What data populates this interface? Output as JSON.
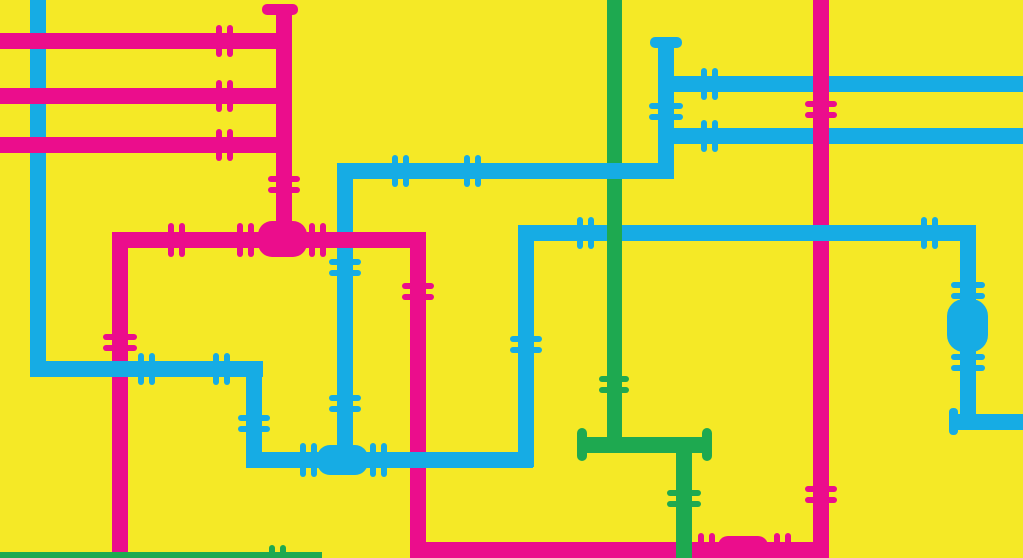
{
  "canvas": {
    "width": 1023,
    "height": 558,
    "background": "#F5E926"
  },
  "colors": {
    "magenta": "#EB0D8C",
    "cyan": "#16ACE4",
    "green": "#1EA950",
    "yellow": "#F5E926"
  },
  "pipes": [
    {
      "name": "pink-top-h1",
      "color": "magenta",
      "x": 0,
      "y": 33,
      "w": 292,
      "h": 16,
      "z": 2
    },
    {
      "name": "pink-top-h2",
      "color": "magenta",
      "x": 0,
      "y": 88,
      "w": 292,
      "h": 16,
      "z": 2
    },
    {
      "name": "pink-top-h3",
      "color": "magenta",
      "x": 0,
      "y": 137,
      "w": 292,
      "h": 16,
      "z": 2
    },
    {
      "name": "pink-capped-v",
      "color": "magenta",
      "x": 276,
      "y": 10,
      "w": 16,
      "h": 230,
      "z": 2
    },
    {
      "name": "pink-mid-h",
      "color": "magenta",
      "x": 112,
      "y": 232,
      "w": 308,
      "h": 16,
      "z": 6
    },
    {
      "name": "pink-left-v",
      "color": "magenta",
      "x": 112,
      "y": 232,
      "w": 16,
      "h": 321,
      "z": 2
    },
    {
      "name": "pink-mid-v",
      "color": "magenta",
      "x": 410,
      "y": 232,
      "w": 16,
      "h": 326,
      "z": 2
    },
    {
      "name": "pink-bottom-h",
      "color": "magenta",
      "x": 410,
      "y": 542,
      "w": 418,
      "h": 16,
      "z": 2
    },
    {
      "name": "pink-right-v",
      "color": "magenta",
      "x": 813,
      "y": 0,
      "w": 16,
      "h": 558,
      "z": 2
    },
    {
      "name": "cyan-topleft-v",
      "color": "cyan",
      "x": 30,
      "y": 0,
      "w": 16,
      "h": 377,
      "z": 1
    },
    {
      "name": "cyan-left-h",
      "color": "cyan",
      "x": 30,
      "y": 361,
      "w": 233,
      "h": 16,
      "z": 3
    },
    {
      "name": "cyan-drop-v",
      "color": "cyan",
      "x": 246,
      "y": 361,
      "w": 16,
      "h": 106,
      "z": 3
    },
    {
      "name": "cyan-valve-h",
      "color": "cyan",
      "x": 246,
      "y": 452,
      "w": 287,
      "h": 16,
      "z": 3
    },
    {
      "name": "cyan-rise-v",
      "color": "cyan",
      "x": 518,
      "y": 225,
      "w": 16,
      "h": 242,
      "z": 3
    },
    {
      "name": "cyan-mid-h",
      "color": "cyan",
      "x": 518,
      "y": 225,
      "w": 457,
      "h": 16,
      "z": 3
    },
    {
      "name": "cyan-right-v",
      "color": "cyan",
      "x": 960,
      "y": 225,
      "w": 16,
      "h": 205,
      "z": 3
    },
    {
      "name": "cyan-right-exit-h",
      "color": "cyan",
      "x": 958,
      "y": 414,
      "w": 65,
      "h": 16,
      "z": 3
    },
    {
      "name": "cyan-long-h",
      "color": "cyan",
      "x": 337,
      "y": 163,
      "w": 337,
      "h": 16,
      "z": 5
    },
    {
      "name": "cyan-tee-v",
      "color": "cyan",
      "x": 337,
      "y": 163,
      "w": 16,
      "h": 297,
      "z": 5
    },
    {
      "name": "cyan-capped-v",
      "color": "cyan",
      "x": 658,
      "y": 42,
      "w": 16,
      "h": 136,
      "z": 5
    },
    {
      "name": "cyan-branch-h1",
      "color": "cyan",
      "x": 658,
      "y": 76,
      "w": 365,
      "h": 16,
      "z": 1
    },
    {
      "name": "cyan-branch-h2",
      "color": "cyan",
      "x": 658,
      "y": 128,
      "w": 365,
      "h": 16,
      "z": 1
    },
    {
      "name": "green-main-v",
      "color": "green",
      "x": 607,
      "y": 0,
      "w": 15,
      "h": 452,
      "z": 4
    },
    {
      "name": "green-tee-h",
      "color": "green",
      "x": 584,
      "y": 437,
      "w": 124,
      "h": 16,
      "z": 4
    },
    {
      "name": "green-drop-v",
      "color": "green",
      "x": 676,
      "y": 437,
      "w": 16,
      "h": 121,
      "z": 4
    },
    {
      "name": "green-bottom-h",
      "color": "green",
      "x": 0,
      "y": 552,
      "w": 322,
      "h": 6,
      "z": 4
    }
  ],
  "fittings": [
    {
      "type": "coupling",
      "name": "coupling-pink-top-h1",
      "color": "magenta",
      "cx": 224,
      "cy": 41,
      "orient": "h",
      "len": 32,
      "z": 2
    },
    {
      "type": "coupling",
      "name": "coupling-pink-top-h2",
      "color": "magenta",
      "cx": 224,
      "cy": 96,
      "orient": "h",
      "len": 32,
      "z": 2
    },
    {
      "type": "coupling",
      "name": "coupling-pink-top-h3",
      "color": "magenta",
      "cx": 224,
      "cy": 145,
      "orient": "h",
      "len": 32,
      "z": 2
    },
    {
      "type": "coupling",
      "name": "coupling-pink-capped-v",
      "color": "magenta",
      "cx": 284,
      "cy": 184,
      "orient": "v",
      "len": 32,
      "z": 2
    },
    {
      "type": "coupling",
      "name": "coupling-pink-mid-h-1",
      "color": "magenta",
      "cx": 176,
      "cy": 240,
      "orient": "h",
      "len": 34,
      "z": 6
    },
    {
      "type": "coupling",
      "name": "coupling-pink-mid-h-2",
      "color": "magenta",
      "cx": 245,
      "cy": 240,
      "orient": "h",
      "len": 34,
      "z": 6
    },
    {
      "type": "coupling",
      "name": "coupling-pink-mid-h-3",
      "color": "magenta",
      "cx": 317,
      "cy": 240,
      "orient": "h",
      "len": 34,
      "z": 6
    },
    {
      "type": "coupling",
      "name": "coupling-pink-left-v",
      "color": "magenta",
      "cx": 120,
      "cy": 342,
      "orient": "v",
      "len": 34,
      "z": 2
    },
    {
      "type": "coupling",
      "name": "coupling-pink-mid-v",
      "color": "magenta",
      "cx": 418,
      "cy": 291,
      "orient": "v",
      "len": 32,
      "z": 2
    },
    {
      "type": "coupling",
      "name": "coupling-pink-bottom-h-1",
      "color": "magenta",
      "cx": 706,
      "cy": 550,
      "orient": "h",
      "len": 34,
      "z": 2
    },
    {
      "type": "coupling",
      "name": "coupling-pink-bottom-h-2",
      "color": "magenta",
      "cx": 782,
      "cy": 550,
      "orient": "h",
      "len": 34,
      "z": 2
    },
    {
      "type": "coupling",
      "name": "coupling-pink-right-v-1",
      "color": "magenta",
      "cx": 821,
      "cy": 109,
      "orient": "v",
      "len": 32,
      "z": 2
    },
    {
      "type": "coupling",
      "name": "coupling-pink-right-v-2",
      "color": "magenta",
      "cx": 821,
      "cy": 494,
      "orient": "v",
      "len": 32,
      "z": 2
    },
    {
      "type": "coupling",
      "name": "coupling-cyan-left-h-1",
      "color": "cyan",
      "cx": 146,
      "cy": 369,
      "orient": "h",
      "len": 32,
      "z": 3
    },
    {
      "type": "coupling",
      "name": "coupling-cyan-left-h-2",
      "color": "cyan",
      "cx": 221,
      "cy": 369,
      "orient": "h",
      "len": 32,
      "z": 3
    },
    {
      "type": "coupling",
      "name": "coupling-cyan-drop-v",
      "color": "cyan",
      "cx": 254,
      "cy": 423,
      "orient": "v",
      "len": 32,
      "z": 3
    },
    {
      "type": "coupling",
      "name": "coupling-cyan-valve-h-1",
      "color": "cyan",
      "cx": 308,
      "cy": 460,
      "orient": "h",
      "len": 34,
      "z": 3
    },
    {
      "type": "coupling",
      "name": "coupling-cyan-valve-h-2",
      "color": "cyan",
      "cx": 378,
      "cy": 460,
      "orient": "h",
      "len": 34,
      "z": 3
    },
    {
      "type": "coupling",
      "name": "coupling-cyan-rise-v",
      "color": "cyan",
      "cx": 526,
      "cy": 344,
      "orient": "v",
      "len": 32,
      "z": 3
    },
    {
      "type": "coupling",
      "name": "coupling-cyan-mid-h-1",
      "color": "cyan",
      "cx": 585,
      "cy": 233,
      "orient": "h",
      "len": 32,
      "z": 3
    },
    {
      "type": "coupling",
      "name": "coupling-cyan-mid-h-2",
      "color": "cyan",
      "cx": 929,
      "cy": 233,
      "orient": "h",
      "len": 32,
      "z": 3
    },
    {
      "type": "coupling",
      "name": "coupling-cyan-right-v-1",
      "color": "cyan",
      "cx": 968,
      "cy": 290,
      "orient": "v",
      "len": 34,
      "z": 3
    },
    {
      "type": "coupling",
      "name": "coupling-cyan-right-v-2",
      "color": "cyan",
      "cx": 968,
      "cy": 362,
      "orient": "v",
      "len": 34,
      "z": 3
    },
    {
      "type": "coupling",
      "name": "coupling-cyan-long-h-1",
      "color": "cyan",
      "cx": 400,
      "cy": 171,
      "orient": "h",
      "len": 32,
      "z": 5
    },
    {
      "type": "coupling",
      "name": "coupling-cyan-long-h-2",
      "color": "cyan",
      "cx": 472,
      "cy": 171,
      "orient": "h",
      "len": 32,
      "z": 5
    },
    {
      "type": "coupling",
      "name": "coupling-cyan-tee-v-1",
      "color": "cyan",
      "cx": 345,
      "cy": 267,
      "orient": "v",
      "len": 32,
      "z": 5
    },
    {
      "type": "coupling",
      "name": "coupling-cyan-tee-v-2",
      "color": "cyan",
      "cx": 345,
      "cy": 403,
      "orient": "v",
      "len": 32,
      "z": 5
    },
    {
      "type": "coupling",
      "name": "coupling-cyan-capped-v",
      "color": "cyan",
      "cx": 666,
      "cy": 111,
      "orient": "v",
      "len": 34,
      "z": 5
    },
    {
      "type": "coupling",
      "name": "coupling-cyan-branch-h1",
      "color": "cyan",
      "cx": 709,
      "cy": 84,
      "orient": "h",
      "len": 32,
      "z": 1
    },
    {
      "type": "coupling",
      "name": "coupling-cyan-branch-h2",
      "color": "cyan",
      "cx": 709,
      "cy": 136,
      "orient": "h",
      "len": 32,
      "z": 1
    },
    {
      "type": "coupling",
      "name": "coupling-green-main-v",
      "color": "green",
      "cx": 614,
      "cy": 384,
      "orient": "v",
      "len": 30,
      "z": 4
    },
    {
      "type": "coupling",
      "name": "coupling-green-drop-v",
      "color": "green",
      "cx": 684,
      "cy": 498,
      "orient": "v",
      "len": 34,
      "z": 4
    },
    {
      "type": "coupling",
      "name": "coupling-green-bottom-h",
      "color": "green",
      "cx": 277,
      "cy": 552,
      "orient": "h",
      "len": 14,
      "z": 4
    },
    {
      "type": "valve",
      "name": "pink-tee-valve",
      "color": "magenta",
      "x": 258,
      "y": 221,
      "w": 49,
      "h": 36,
      "r": 14,
      "z": 6
    },
    {
      "type": "valve",
      "name": "cyan-tee-valve",
      "color": "cyan",
      "x": 317,
      "y": 445,
      "w": 51,
      "h": 30,
      "r": 13,
      "z": 3
    },
    {
      "type": "valve",
      "name": "cyan-inline-valve",
      "color": "cyan",
      "x": 947,
      "y": 299,
      "w": 41,
      "h": 53,
      "r": 17,
      "z": 3
    },
    {
      "type": "valve",
      "name": "pink-inline-valve",
      "color": "magenta",
      "x": 718,
      "y": 536,
      "w": 50,
      "h": 22,
      "r": 10,
      "z": 2
    },
    {
      "type": "cap",
      "name": "pink-end-cap",
      "color": "magenta",
      "x": 262,
      "y": 4,
      "w": 36,
      "h": 11,
      "r": 5,
      "z": 2
    },
    {
      "type": "cap",
      "name": "cyan-end-cap",
      "color": "cyan",
      "x": 650,
      "y": 37,
      "w": 32,
      "h": 11,
      "r": 5,
      "z": 5
    },
    {
      "type": "cap",
      "name": "green-left-end-cap",
      "color": "green",
      "x": 577,
      "y": 428,
      "w": 10,
      "h": 33,
      "r": 5,
      "z": 4
    },
    {
      "type": "cap",
      "name": "green-right-end-cap",
      "color": "green",
      "x": 702,
      "y": 428,
      "w": 10,
      "h": 33,
      "r": 5,
      "z": 4
    },
    {
      "type": "cap",
      "name": "cyan-elbow-flange",
      "color": "cyan",
      "x": 949,
      "y": 408,
      "w": 9,
      "h": 27,
      "r": 4,
      "z": 3
    }
  ]
}
